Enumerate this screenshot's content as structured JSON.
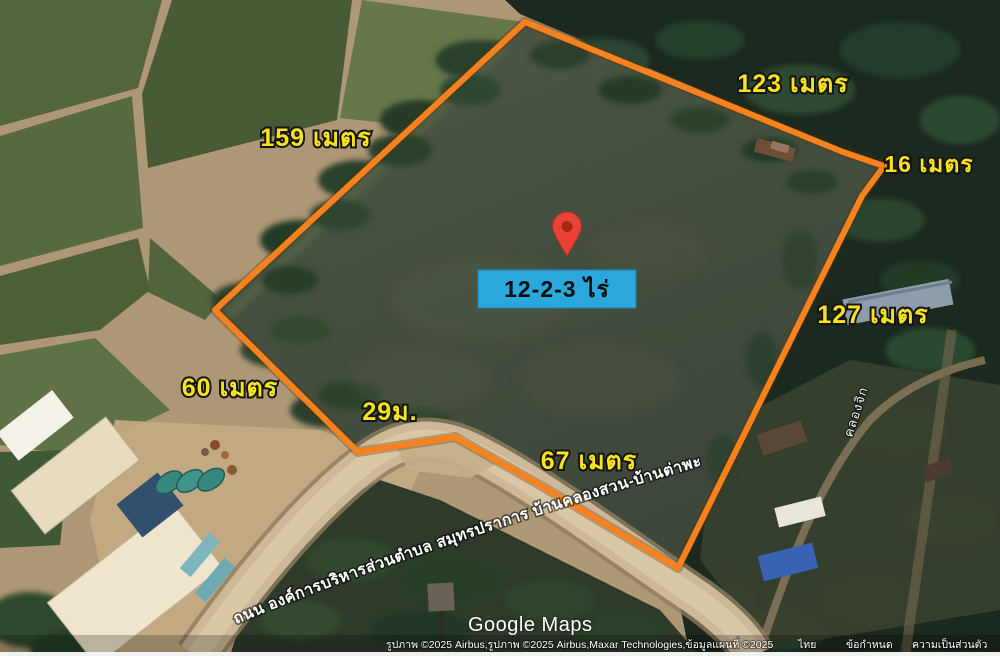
{
  "map": {
    "provider": "Google Maps",
    "watermark_label": "Google Maps",
    "parcel": {
      "area_label": "12-2-3 ไร่",
      "area_label_bg": "#2AA7DB",
      "outline_color": "#F5821F",
      "measurement_label_color": "#F7E31B",
      "pin_color": "#EA4335",
      "measurements": [
        {
          "side": "northwest",
          "label": "159 เมตร"
        },
        {
          "side": "northeast",
          "label": "123 เมตร"
        },
        {
          "side": "east-notch",
          "label": "16 เมตร"
        },
        {
          "side": "east",
          "label": "127 เมตร"
        },
        {
          "side": "southwest",
          "label": "60 เมตร"
        },
        {
          "side": "south-bend",
          "label": "29ม."
        },
        {
          "side": "south",
          "label": "67 เมตร"
        }
      ]
    },
    "roads": {
      "main_road_label": "ถนน องค์การบริหารส่วนตำบล สมุทรปราการ บ้านคลองสวน-บ้านต่าพะ",
      "side_road_label": "คลองจิก"
    },
    "attribution": {
      "imagery": "รูปภาพ ©2025 Airbus,รูปภาพ ©2025 Airbus,Maxar Technologies,ข้อมูลแผนที่ ©2025",
      "region_link": "ไทย",
      "terms_link": "ข้อกำหนด",
      "privacy_link": "ความเป็นส่วนตัว"
    }
  }
}
